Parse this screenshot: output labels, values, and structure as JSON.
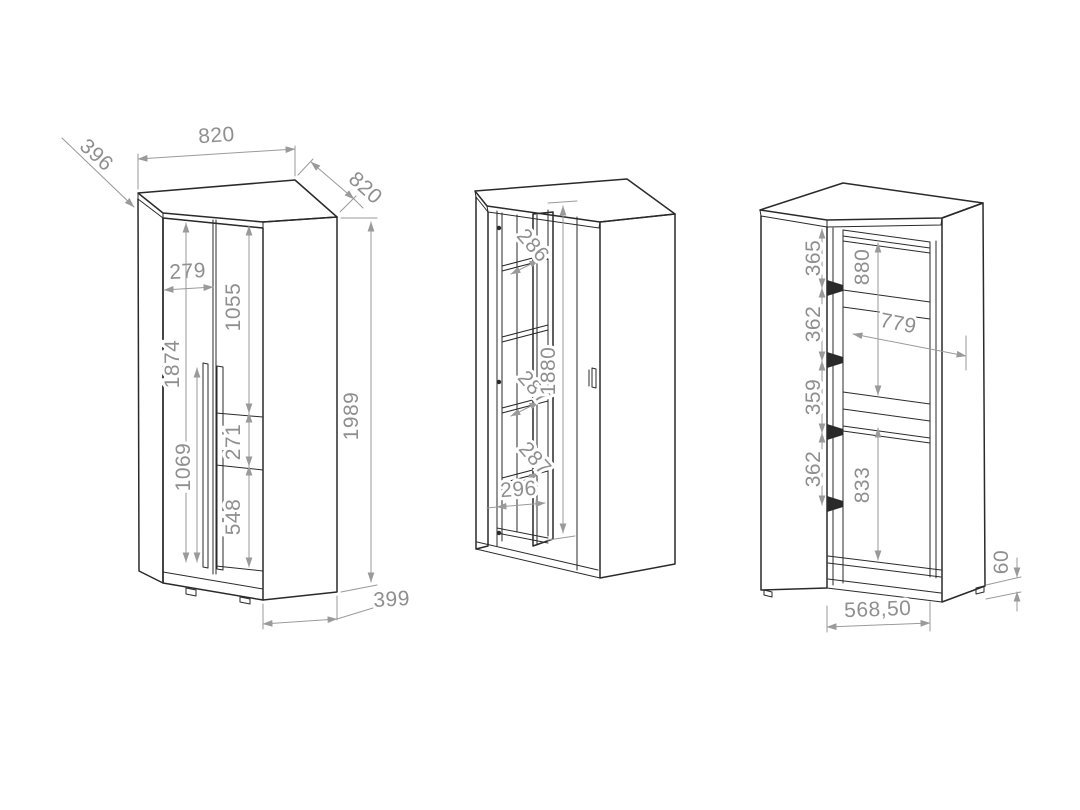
{
  "drawing": {
    "type": "furniture-technical-drawing",
    "subject": "corner wardrobe - three dimensioned views",
    "colors": {
      "background": "#ffffff",
      "outline": "#2a2a2a",
      "dimension": "#9a9a9a"
    },
    "views": {
      "left": {
        "label": "closed-front-view",
        "dims": {
          "top_width": "820",
          "left_depth": "396",
          "right_depth": "820",
          "total_height": "1989",
          "side_width": "399",
          "door_front_width": "279",
          "door_height": "1874",
          "handle_length": "1069",
          "upper_panel": "1055",
          "middle_panel": "271",
          "lower_panel": "548"
        }
      },
      "middle": {
        "label": "open-door-shelf-view",
        "dims": {
          "shelf_clear_top": "286",
          "shelf_clear_mid": "287",
          "shelf_clear_low": "287",
          "shelf_width": "296",
          "interior_height": "1880"
        }
      },
      "right": {
        "label": "open-interior-rail-view",
        "dims": {
          "pitch_1": "365",
          "pitch_2": "362",
          "pitch_3": "359",
          "pitch_4": "362",
          "upper_hang_height": "880",
          "interior_width": "779",
          "lower_hang_height": "833",
          "base_height": "60",
          "base_width": "568,50"
        }
      }
    }
  }
}
